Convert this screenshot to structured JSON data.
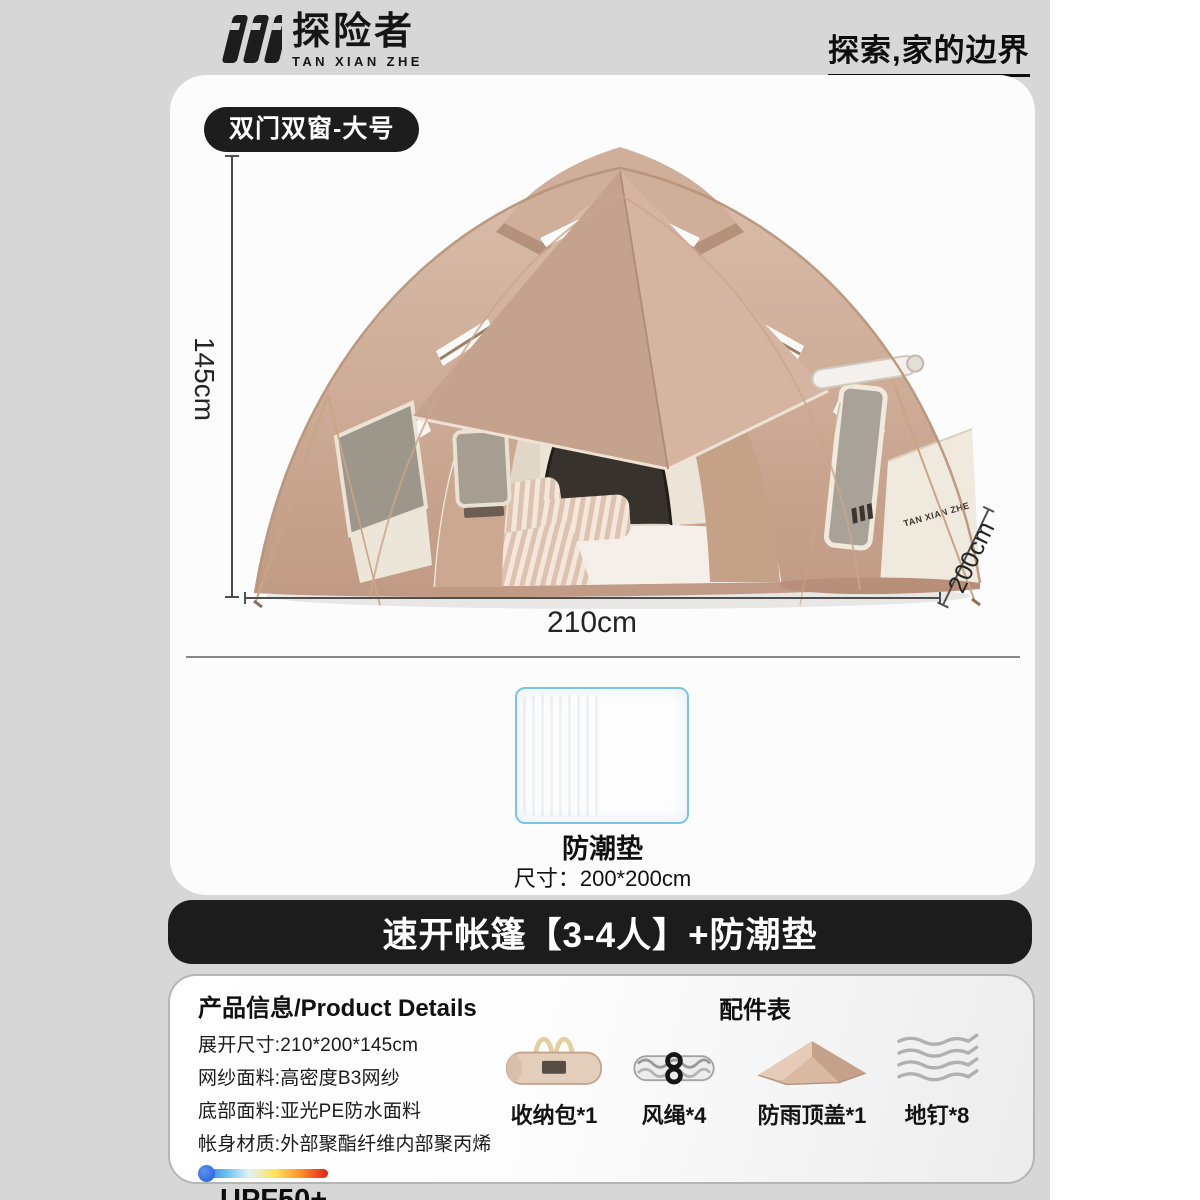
{
  "header": {
    "brand_cn": "探险者",
    "brand_en": "TAN XIAN ZHE",
    "slogan": "探索,家的边界",
    "logo_icon": "tanxianzhe-triple-stroke-logo"
  },
  "hero": {
    "badge": "双门双窗-大号",
    "height_label": "145cm",
    "width_label": "210cm",
    "depth_label": "200cm",
    "tent_brand": "TAN XIAN ZHE"
  },
  "pad": {
    "name": "防潮垫",
    "size": "尺寸：200*200cm"
  },
  "banner": {
    "title": "速开帐篷【3-4人】+防潮垫"
  },
  "details": {
    "title": "产品信息/Product Details",
    "lines": [
      "展开尺寸:210*200*145cm",
      "网纱面料:高密度B3网纱",
      "底部面料:亚光PE防水面料",
      "帐身材质:外部聚酯纤维内部聚丙烯"
    ],
    "upf": "UPF50+"
  },
  "accessories": {
    "title": "配件表",
    "items": [
      {
        "icon": "storage-bag-icon",
        "label": "收纳包*1"
      },
      {
        "icon": "wind-rope-icon",
        "label": "风绳*4"
      },
      {
        "icon": "rain-cover-icon",
        "label": "防雨顶盖*1"
      },
      {
        "icon": "stakes-icon",
        "label": "地钉*8"
      }
    ]
  },
  "colors": {
    "page_gray": "#d7d7d7",
    "accent_black": "#1c1c1c",
    "pad_border_blue": "#7ac4e8",
    "tent_tan": "#cdab96"
  }
}
